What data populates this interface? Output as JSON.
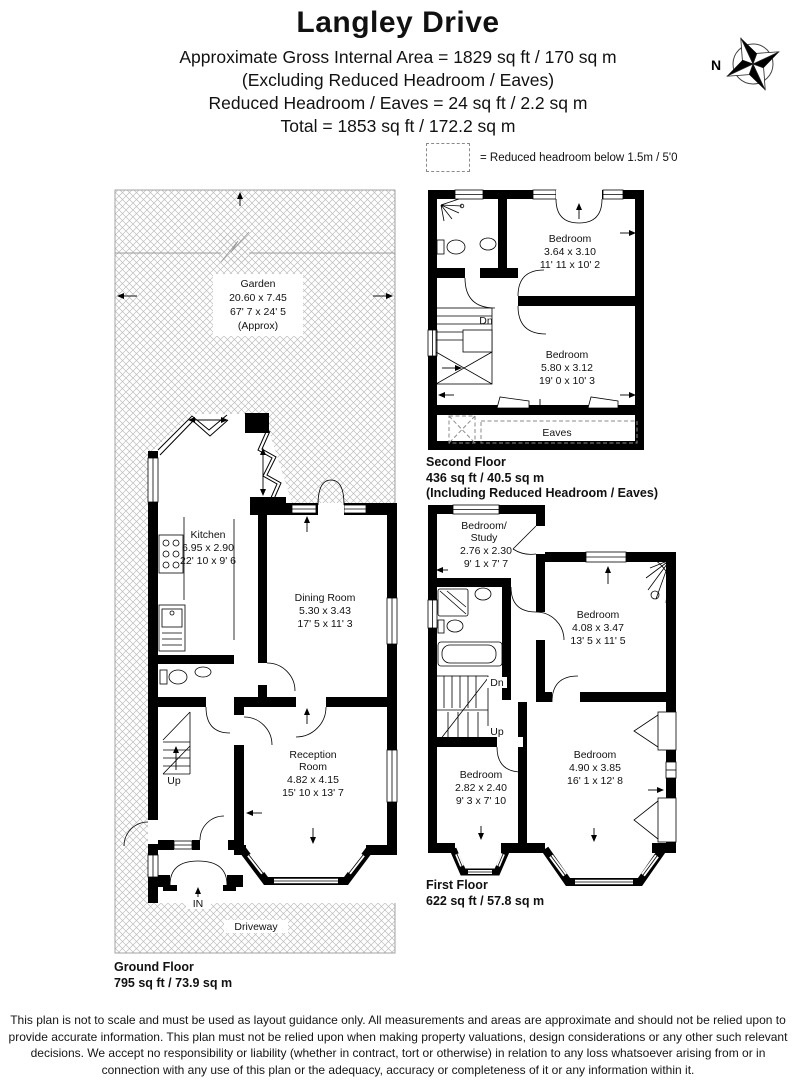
{
  "title": "Langley Drive",
  "header": {
    "line1": "Approximate Gross Internal Area = 1829 sq ft / 170 sq m",
    "line2": "(Excluding Reduced Headroom / Eaves)",
    "line3": "Reduced Headroom / Eaves  = 24 sq ft / 2.2 sq m",
    "line4": "Total = 1853 sq ft / 172.2 sq m"
  },
  "compass": {
    "north_label": "N"
  },
  "legend": {
    "label": "= Reduced headroom below 1.5m / 5'0"
  },
  "colors": {
    "wall": "#000000",
    "hatch": "#bdbdbd",
    "dashed": "#8a8a8a"
  },
  "ground_floor": {
    "floor_label": "Ground Floor",
    "floor_area": "795 sq ft / 73.9 sq m",
    "garden": {
      "name": "Garden",
      "metric": "20.60 x 7.45",
      "imperial": "67' 7 x 24' 5",
      "note": "(Approx)"
    },
    "driveway_label": "Driveway",
    "kitchen": {
      "name": "Kitchen",
      "metric": "6.95 x 2.90",
      "imperial": "22' 10 x 9' 6"
    },
    "dining": {
      "name": "Dining Room",
      "metric": "5.30 x 3.43",
      "imperial": "17' 5 x 11' 3"
    },
    "reception": {
      "name1": "Reception",
      "name2": "Room",
      "metric": "4.82 x 4.15",
      "imperial": "15' 10 x 13' 7"
    },
    "up_label": "Up",
    "in_label": "IN"
  },
  "first_floor": {
    "floor_label": "First Floor",
    "floor_area": "622 sq ft / 57.8 sq m",
    "study": {
      "name1": "Bedroom/",
      "name2": "Study",
      "metric": "2.76 x 2.30",
      "imperial": "9' 1 x 7' 7"
    },
    "bedroom_right": {
      "name": "Bedroom",
      "metric": "4.08 x 3.47",
      "imperial": "13' 5 x 11' 5"
    },
    "bedroom_small": {
      "name": "Bedroom",
      "metric": "2.82 x 2.40",
      "imperial": "9' 3 x 7' 10"
    },
    "bedroom_bay": {
      "name": "Bedroom",
      "metric": "4.90 x 3.85",
      "imperial": "16' 1 x 12' 8"
    },
    "dn_label": "Dn",
    "up_label": "Up"
  },
  "second_floor": {
    "floor_label": "Second Floor",
    "floor_area": "436 sq ft / 40.5 sq m",
    "floor_note": "(Including Reduced Headroom / Eaves)",
    "bedroom_top": {
      "name": "Bedroom",
      "metric": "3.64 x 3.10",
      "imperial": "11' 11 x 10' 2"
    },
    "bedroom_main": {
      "name": "Bedroom",
      "metric": "5.80 x 3.12",
      "imperial": "19' 0 x 10' 3"
    },
    "eaves_label": "Eaves",
    "dn_label": "Dn"
  },
  "disclaimer": "This plan is not to scale and must be used as layout guidance only. All measurements and areas are approximate and should not be relied upon to provide accurate information. This plan must not be relied upon when making property valuations, design considerations or any other such relevant decisions. We accept no responsibility or liability (whether in contract, tort or otherwise) in relation to any loss whatsoever arising from or in connection with any use of this plan or the adequacy, accuracy or completeness of it or any information within it."
}
